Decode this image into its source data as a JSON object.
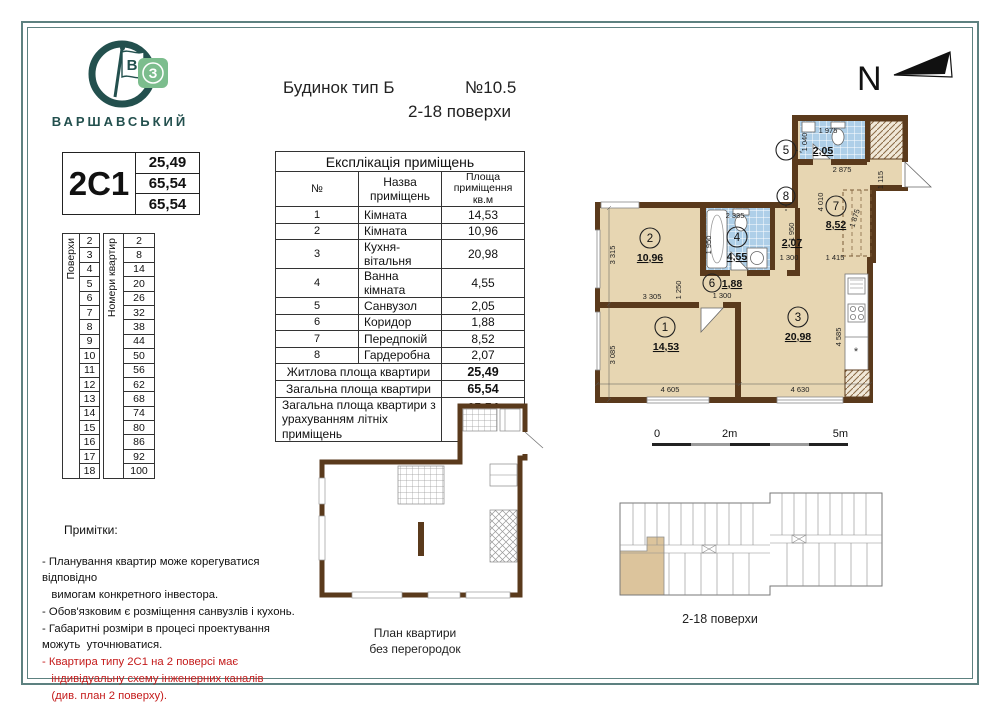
{
  "brand": {
    "name": "ВАРШАВСЬКИЙ",
    "flag_letter": "В",
    "square_letter": "З"
  },
  "header": {
    "building_type": "Будинок тип Б",
    "number": "№10.5",
    "floors": "2-18  поверхи"
  },
  "compass": {
    "label": "N"
  },
  "apartment_card": {
    "code": "2С1",
    "values": [
      "25,49",
      "65,54",
      "65,54"
    ]
  },
  "floors_column": {
    "label": "Поверхи",
    "values": [
      "2",
      "3",
      "4",
      "5",
      "6",
      "7",
      "8",
      "9",
      "10",
      "11",
      "12",
      "13",
      "14",
      "15",
      "16",
      "17",
      "18"
    ]
  },
  "apartments_column": {
    "label": "Номери квартир",
    "values": [
      "2",
      "8",
      "14",
      "20",
      "26",
      "32",
      "38",
      "44",
      "50",
      "56",
      "62",
      "68",
      "74",
      "80",
      "86",
      "92",
      "100"
    ]
  },
  "explication": {
    "title": "Експлікація приміщень",
    "columns": {
      "num": "№",
      "name": "Назва приміщень",
      "area_l1": "Площа",
      "area_l2": "приміщення",
      "area_l3": "кв.м"
    },
    "rows": [
      {
        "num": "1",
        "name": "Кімната",
        "area": "14,53"
      },
      {
        "num": "2",
        "name": "Кімната",
        "area": "10,96"
      },
      {
        "num": "3",
        "name": "Кухня-вітальня",
        "area": "20,98"
      },
      {
        "num": "4",
        "name": "Ванна кімната",
        "area": "4,55"
      },
      {
        "num": "5",
        "name": "Санвузол",
        "area": "2,05"
      },
      {
        "num": "6",
        "name": "Коридор",
        "area": "1,88"
      },
      {
        "num": "7",
        "name": "Передпокій",
        "area": "8,52"
      },
      {
        "num": "8",
        "name": "Гардеробна",
        "area": "2,07"
      }
    ],
    "summary": [
      {
        "label": "Житлова площа квартири",
        "value": "25,49"
      },
      {
        "label": "Загальна площа квартири",
        "value": "65,54"
      }
    ],
    "summary_last": {
      "label": "Загальна площа квартири з урахуванням літніх приміщень",
      "value": "65,54"
    }
  },
  "plan": {
    "rooms": {
      "r1": {
        "num": "1",
        "area": "14,53"
      },
      "r2": {
        "num": "2",
        "area": "10,96"
      },
      "r3": {
        "num": "3",
        "area": "20,98"
      },
      "r4": {
        "num": "4",
        "area": "4,55"
      },
      "r5": {
        "num": "5",
        "area": "2,05"
      },
      "r6": {
        "num": "6",
        "area": "1,88"
      },
      "r7": {
        "num": "7",
        "area": "8,52"
      },
      "r8": {
        "num": "8",
        "area": "2,07"
      }
    },
    "dims": {
      "v3315": "3 315",
      "h3305": "3 305",
      "v1250": "1 250",
      "h1300a": "1 300",
      "v3085": "3 085",
      "h4605": "4 605",
      "h4630": "4 630",
      "v4585": "4 585",
      "v1950a": "1 950",
      "h2335": "2 335",
      "v1950b": "1 950",
      "h1300b": "1 300",
      "h1415": "1 415",
      "v4010": "4 010",
      "d1875": "1 875",
      "h2875": "2 875",
      "v1115": "1 115",
      "h1975": "1 975",
      "v1040": "1 040"
    },
    "fridge_symbol": "*",
    "scale": {
      "zero": "0",
      "two": "2m",
      "five": "5m"
    }
  },
  "plan_outline_caption": {
    "line1": "План квартири",
    "line2": "без перегородок"
  },
  "overview": {
    "caption": "2-18 поверхи"
  },
  "notes": {
    "title": "Примітки:",
    "lines": [
      {
        "text": "- Планування квартир може корегуватися",
        "red": false
      },
      {
        "text": "відповідно",
        "red": false
      },
      {
        "text": "   вимогам конкретного інвестора.",
        "red": false
      },
      {
        "text": "- Обов'язковим є розміщення санвузлів і кухонь.",
        "red": false
      },
      {
        "text": "- Габаритні розміри в процесі проектування",
        "red": false
      },
      {
        "text": "можуть  уточнюватися.",
        "red": false
      },
      {
        "text": "- Квартира типу 2С1 на 2 поверсі має",
        "red": true
      },
      {
        "text": "   індивідуальну схему інженерних каналів",
        "red": true
      },
      {
        "text": "   (див. план 2 поверху).",
        "red": true
      }
    ]
  },
  "colors": {
    "teal": "#23504e",
    "frame": "#5d8180",
    "wall": "#5a3a1c",
    "floor": "#e7d6b2",
    "tile": "#aecfe8",
    "note_red": "#c41a1a",
    "highlight_tan": "#dcc49c"
  }
}
